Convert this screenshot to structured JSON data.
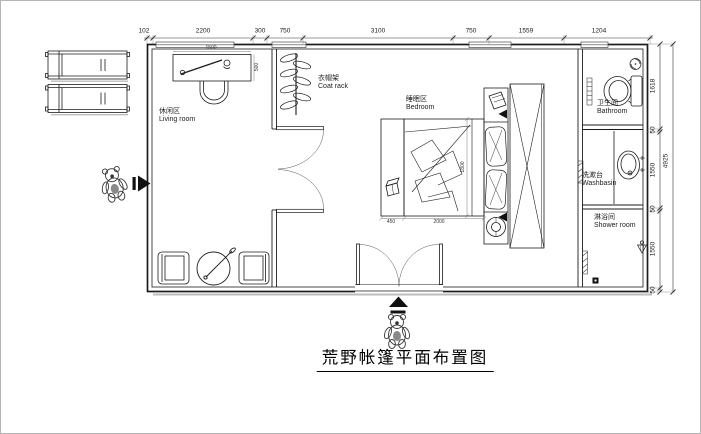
{
  "title": "荒野帐篷平面布置图",
  "rooms": {
    "living": {
      "zh": "休闲区",
      "en": "Living room"
    },
    "coat_rack": {
      "zh": "衣帽架",
      "en": "Coat rack"
    },
    "bedroom": {
      "zh": "睡眠区",
      "en": "Bedroom"
    },
    "bathroom": {
      "zh": "卫生间",
      "en": "Bathroom"
    },
    "washbasin": {
      "zh": "洗漱台",
      "en": "Washbasin"
    },
    "shower": {
      "zh": "淋浴间",
      "en": "Shower room"
    }
  },
  "dims": {
    "top": [
      "102",
      "2200",
      "300",
      "750",
      "3100",
      "750",
      "1559",
      "1204"
    ],
    "right": [
      "1618",
      "50",
      "1550",
      "50",
      "1550",
      "50"
    ],
    "right_total": "4925",
    "furniture": {
      "desk_w": "1500",
      "desk_d": "500",
      "bed_l": "1800",
      "bed_w": "2000",
      "bench_w": "450"
    }
  },
  "colors": {
    "line": "#1c1c1c",
    "dim": "#333333",
    "shadow": "#bdbdbd",
    "paper": "#ffffff"
  }
}
